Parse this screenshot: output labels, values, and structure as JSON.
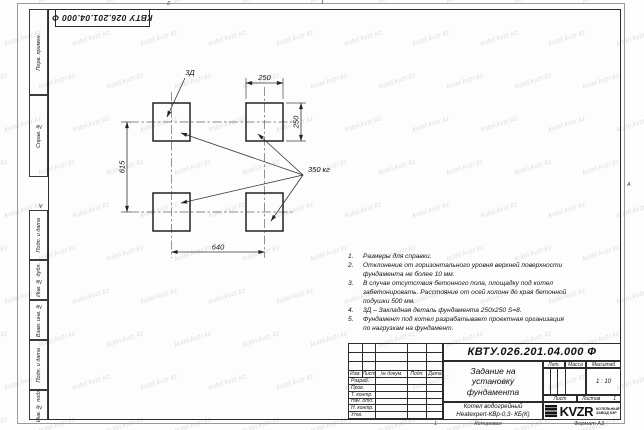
{
  "sheet": {
    "designation_rotated": "КВТУ 026.201.04.000 Ф",
    "zones": {
      "top": "2",
      "bottom": "1",
      "left": "А",
      "right": "А"
    },
    "footer": {
      "copied": "Копировал",
      "format": "Формат А3"
    }
  },
  "margin_boxes": [
    {
      "label": "Перв. примен."
    },
    {
      "label": "Справ. №"
    },
    {
      "label": "Подп. и дата"
    },
    {
      "label": "Инв. № дубл."
    },
    {
      "label": "Взам. инв. №"
    },
    {
      "label": "Подп. и дата"
    },
    {
      "label": "Инв. № подл."
    }
  ],
  "drawing": {
    "labels": {
      "detail": "3Д",
      "load": "350 кг",
      "dim_top": "250",
      "dim_right": "250",
      "dim_left": "615",
      "dim_bottom": "640"
    }
  },
  "notes": {
    "items": [
      {
        "num": "1.",
        "text": "Размеры для справки."
      },
      {
        "num": "2.",
        "text": "Отклонение от горизонтального уровня верхней поверхности фундамента не более 10 мм."
      },
      {
        "num": "3.",
        "text": "В случае отсутствия бетонного пола, площадку под котел забетонировать. Расстояние от осей колонн до края бетонной подушки 500 мм."
      },
      {
        "num": "4.",
        "text": "3Д – Закладная деталь фундамента 250х250 S=8."
      },
      {
        "num": "5.",
        "text": "Фундамент под котел разрабатывает проектная организация по нагрузкам на фундамент."
      }
    ]
  },
  "title_block": {
    "designation": "КВТУ.026.201.04.000 Ф",
    "doc_title": "Задание на установку фундамента",
    "product_name_line1": "Котел водогрейный",
    "product_name_line2": "Heatexpert-КВр-0,3- КБ(К)",
    "headers": {
      "izm": "Изм.",
      "list": "Лист",
      "doc": "№ докум.",
      "sign": "Подп.",
      "date": "Дата",
      "lit": "Лит.",
      "mass": "Масса",
      "scale": "Масштаб",
      "sheet": "Лист",
      "sheets": "Листов"
    },
    "rows": [
      "Разраб.",
      "Пров.",
      "Т. контр.",
      "Нач. отд.",
      "Н. контр.",
      "Утв."
    ],
    "scale_value": "1 : 10",
    "sheets_value": "1",
    "logo": {
      "text": "KVZR",
      "sub1": "КОТЕЛЬНЫЙ",
      "sub2": "ЗАВОД КЗР"
    }
  },
  "watermark": {
    "text": "kotel.kvzr.kz",
    "color": "#e0e0e0"
  }
}
